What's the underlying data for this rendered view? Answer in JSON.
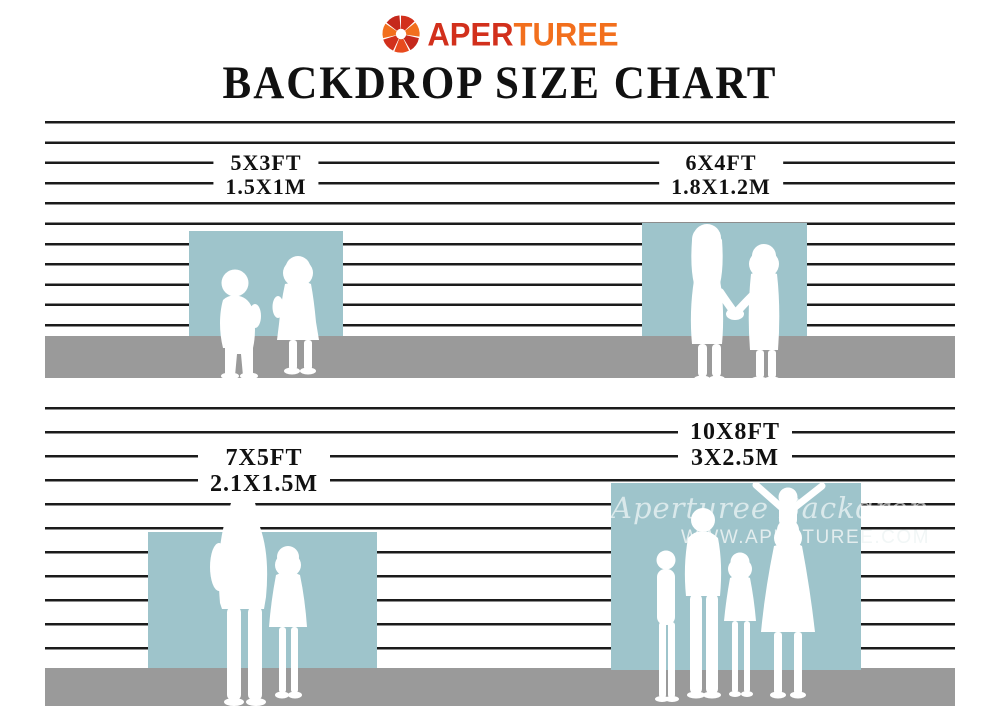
{
  "header": {
    "brand": {
      "name_part1": "APER",
      "name_part2": "TUREE",
      "icon": "aperture-shutter-icon"
    },
    "title": "BACKDROP SIZE CHART"
  },
  "sections": [
    {
      "name": "row-1",
      "backdrops": [
        {
          "size_ft": "5X3FT",
          "size_m": "1.5X1M",
          "figures": "two-toddlers"
        },
        {
          "size_ft": "6X4FT",
          "size_m": "1.8X1.2M",
          "figures": "two-girls-holding-hands"
        }
      ]
    },
    {
      "name": "row-2",
      "backdrops": [
        {
          "size_ft": "7X5FT",
          "size_m": "2.1X1.5M",
          "figures": "father-and-daughter"
        },
        {
          "size_ft": "10X8FT",
          "size_m": "3X2.5M",
          "figures": "family-with-child-on-shoulders",
          "watermark": {
            "line1": "Aperturee Backdrop",
            "line2": "WWW.APERTUREE.COM"
          }
        }
      ]
    }
  ],
  "colors": {
    "backdrop_blue": "#9EC4CB",
    "floor_gray": "#9A9A9A",
    "line_black": "#1B1B1B",
    "logo_red": "#D2301C",
    "logo_orange": "#F26F1D"
  }
}
